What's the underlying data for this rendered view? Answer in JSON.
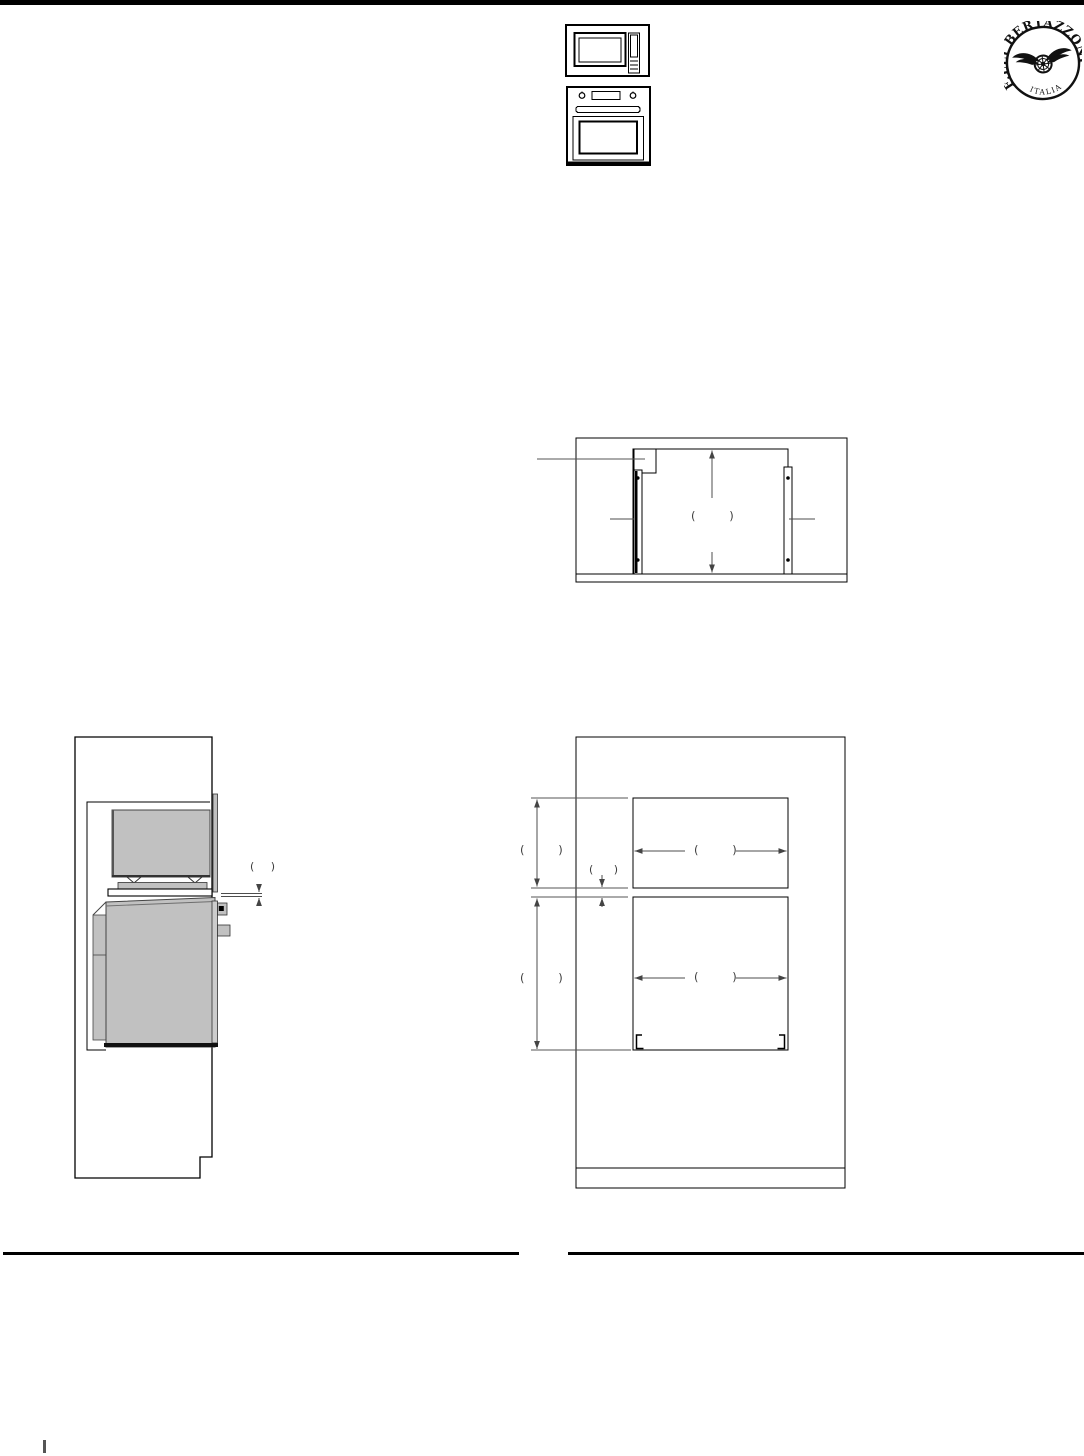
{
  "logo": {
    "brand": "F.LLI BERTAZZONI",
    "country": "ITALIA"
  },
  "labels": {
    "cutout_height": "(        )",
    "side_gap": "(    )",
    "upper_niche_height": "(        )",
    "niche_gap": "(     )",
    "lower_niche_height": "(        )",
    "upper_niche_width": "(        )",
    "lower_niche_width": "(        )"
  },
  "colors": {
    "drawing_line": "#000000",
    "dimension_line": "#4d4d4d",
    "appliance_fill": "#c1c1c1",
    "header_bar": "#000000"
  }
}
